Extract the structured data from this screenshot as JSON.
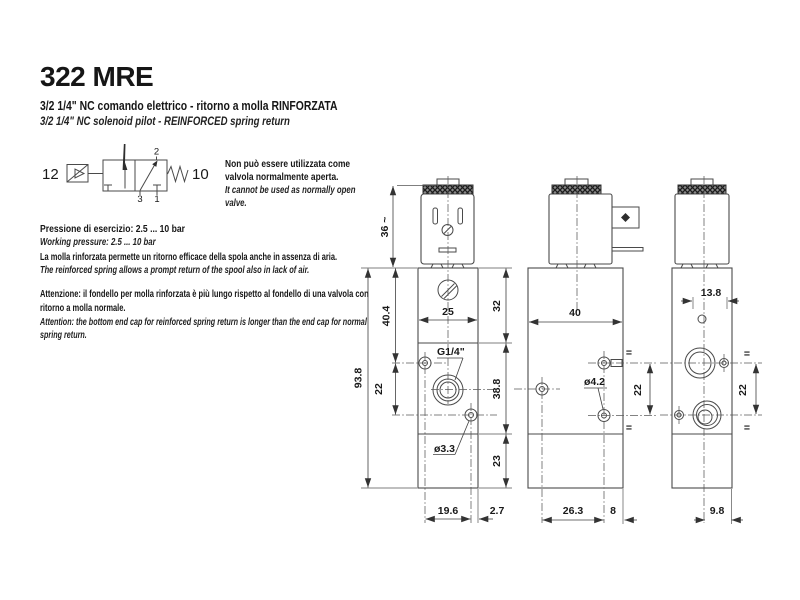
{
  "page": {
    "title": "322 MRE",
    "subtitle_it": "3/2 1/4\" NC comando elettrico - ritorno a molla RINFORZATA",
    "subtitle_en": "3/2 1/4\" NC solenoid pilot - REINFORCED spring return"
  },
  "symbol": {
    "pilot_port": "12",
    "spring_port": "10",
    "port_top": "2",
    "port_bottom_left": "3",
    "port_bottom_right": "1"
  },
  "notes": {
    "nc_it": "Non può essere utilizzata come valvola normalmente aperta.",
    "nc_en": "It cannot be used as normally open valve.",
    "pressure_it": "Pressione di esercizio: 2.5 ... 10 bar",
    "pressure_en": "Working pressure: 2.5 ... 10 bar",
    "spring_it": "La molla rinforzata permette un ritorno efficace della spola anche in assenza di aria.",
    "spring_en": "The reinforced spring allows a prompt return of the spool also in lack of air.",
    "warn_it": "Attenzione: il fondello per molla rinforzata è più lungo rispetto al fondello di una valvola con ritorno a molla normale.",
    "warn_en": "Attention: the bottom end cap for reinforced spring return is longer than the end cap for normal spring return."
  },
  "dims": {
    "front": {
      "coil_height": "36 ~",
      "body_to_port": "40.4",
      "port_spacing": "22",
      "total_height": "93.8",
      "body_width": "25",
      "top_section": "32",
      "mid_section": "38.8",
      "end_cap": "23",
      "port_thread": "G1/4\"",
      "pilot_hole": "ø3.3",
      "bottom_offset_a": "19.6",
      "bottom_offset_b": "2.7"
    },
    "side": {
      "body_depth": "40",
      "mount_hole": "ø4.2",
      "port_spacing": "22",
      "bottom_offset_a": "26.3",
      "bottom_offset_b": "8",
      "equal_mark": "="
    },
    "back": {
      "top_offset": "13.8",
      "port_spacing": "22",
      "bottom_offset": "9.8",
      "equal_mark": "="
    }
  }
}
